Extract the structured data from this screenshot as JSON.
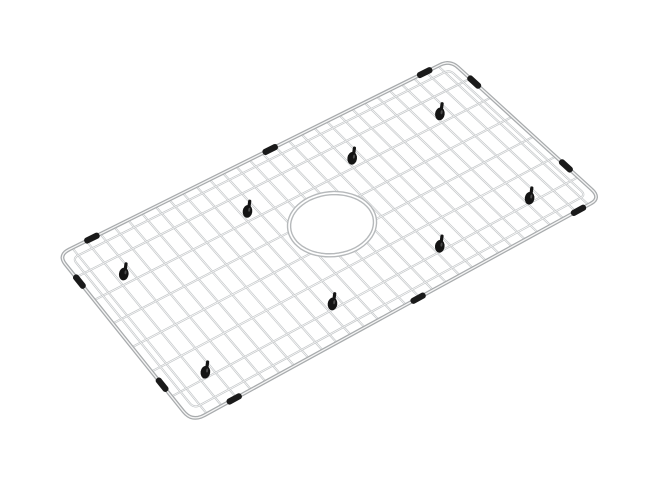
{
  "meta": {
    "description": "Stainless steel kitchen sink bottom grid with rounded-corner wire frame, rectangular wire mesh, center drain opening, black rubber rim bumpers and black hook feet, shown in perspective on a white background",
    "background_color": "#ffffff"
  },
  "scene": {
    "canvas": {
      "width": 658,
      "height": 482
    },
    "grid": {
      "corners": {
        "left": [
          58,
          255
        ],
        "top": [
          450,
          60
        ],
        "right": [
          601,
          198
        ],
        "bottom": [
          192,
          422
        ]
      },
      "corner_radius": {
        "u": 0.027,
        "v": 0.058
      },
      "columns": 30,
      "rows": 7,
      "inner_offset": {
        "u": 0.02,
        "v": 0.048
      },
      "inner_corner_radius": {
        "u": 0.014,
        "v": 0.03
      },
      "wire_color": "#c4c7c9",
      "wire_highlight": "#ffffff",
      "wire_width": 2.1,
      "frame_color": "#a8abad",
      "frame_highlight": "#f5f5f5",
      "frame_width": 3.8
    },
    "hole": {
      "u": 0.505,
      "v": 0.49,
      "ru": 0.09,
      "rv": 0.165,
      "fill": "#ffffff",
      "ring_color": "#b6b9bb",
      "ring_width": 4.5
    },
    "feet": {
      "color": "#141414",
      "glint_color": "#4a4a4a",
      "u": [
        0.1,
        0.4,
        0.6667,
        0.9
      ],
      "v": [
        0.2,
        0.8
      ],
      "tilt_deg": 8
    },
    "bumpers": {
      "color": "#1a1a1a",
      "length": 16.5,
      "thickness": 6.2,
      "top": [
        0.08,
        0.52,
        0.93
      ],
      "bottom": [
        0.095,
        0.53,
        0.94
      ],
      "left": [
        0.17,
        0.79
      ],
      "right": [
        0.17,
        0.78
      ]
    }
  }
}
